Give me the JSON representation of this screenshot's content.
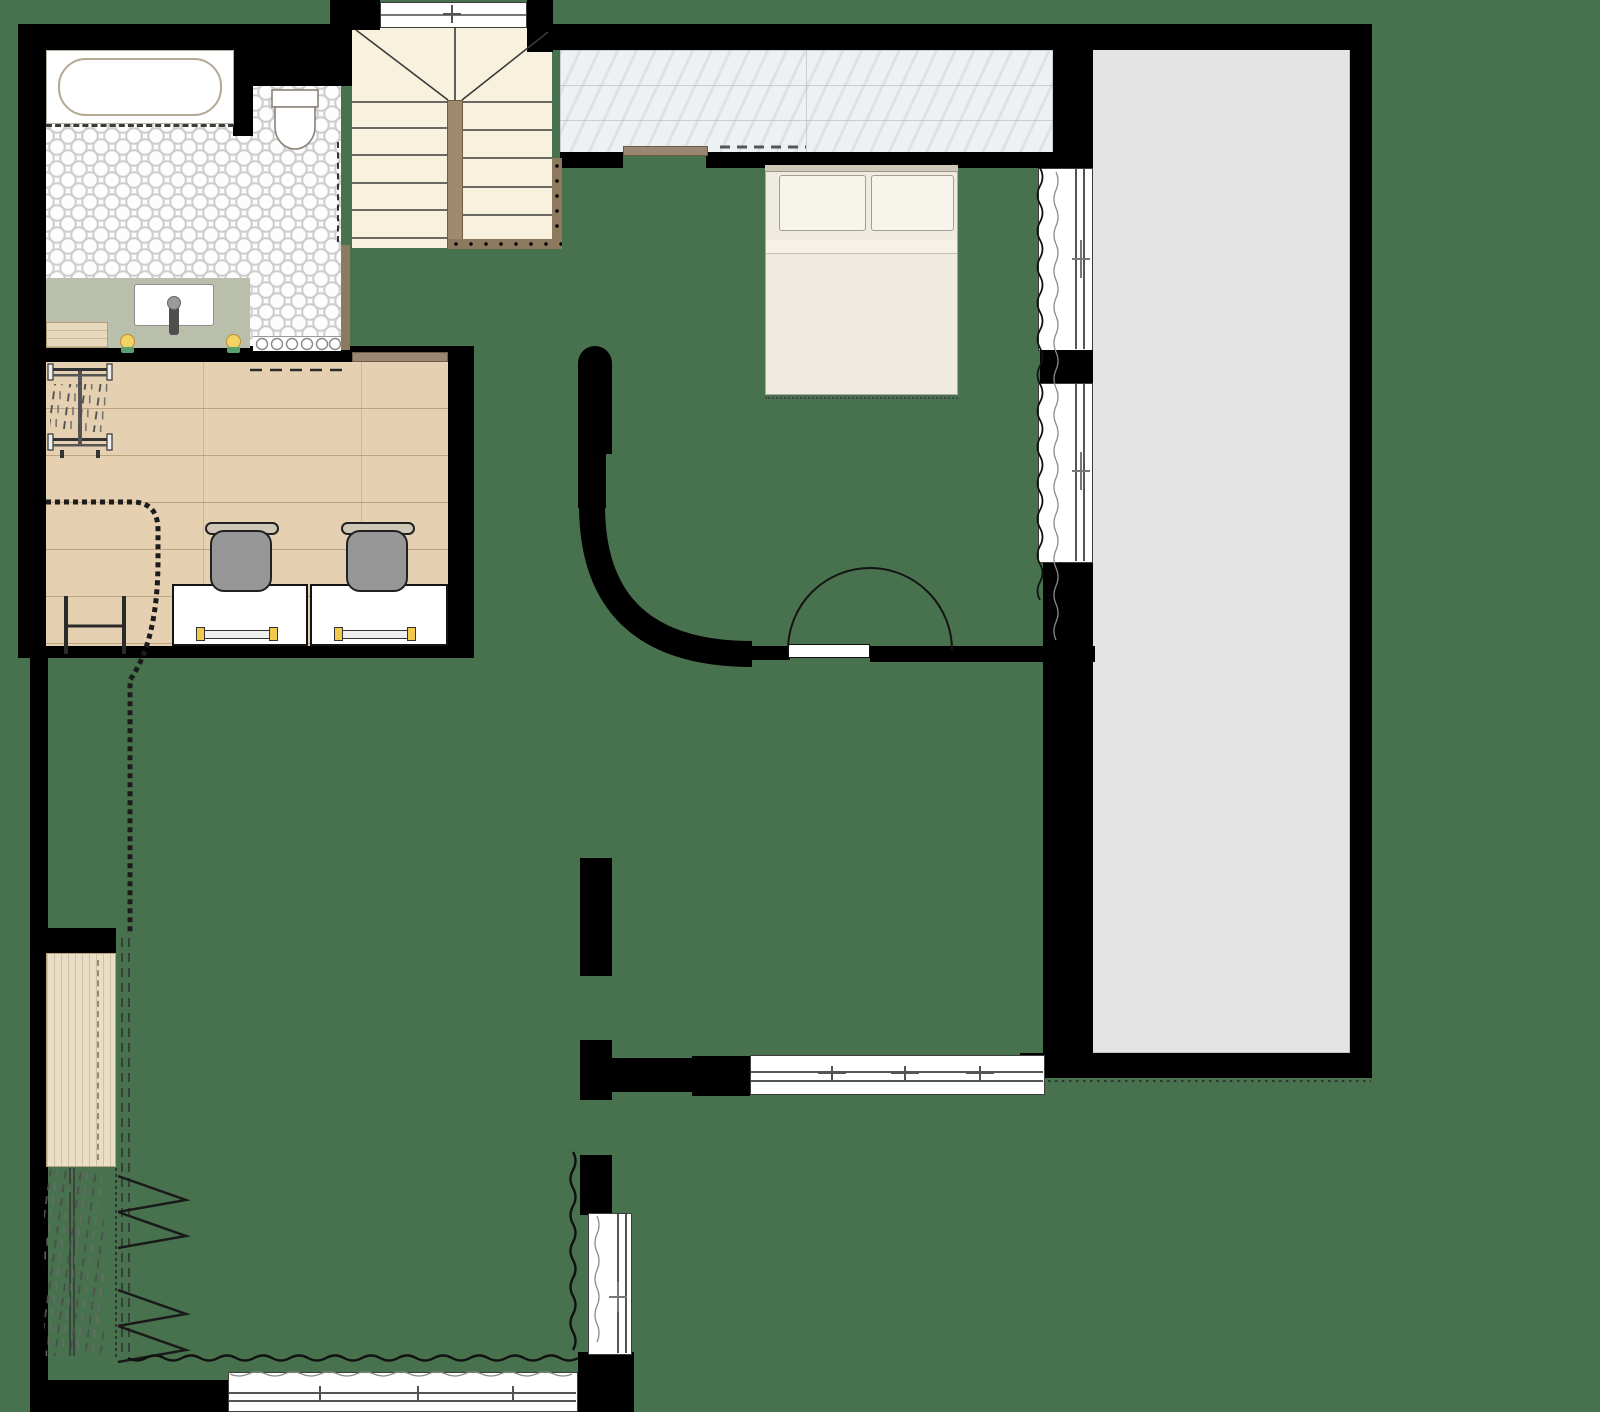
{
  "title": "apartment-upper-floor-plan",
  "colors": {
    "bg": "#48724e",
    "wall": "#000000",
    "stair": "#f8f1dd",
    "stairwood": "#a08a6e",
    "rail": "#8d7a5e",
    "marble": "#eef1f2",
    "terrace": "#e4e4e4",
    "vanity": "#b9bfaa",
    "wood": "#e5d1b1",
    "panelwood": "#e9dec6",
    "linen": "#f0ebe0",
    "pillow": "#f7f4ec",
    "shelf": "#9b8671",
    "chair": "#979797",
    "lamp": "#f2c94c",
    "candle": "#f2d465",
    "candlebase": "#58a070",
    "win": "#ffffff"
  },
  "legend": {
    "rooms": [
      "bathroom",
      "staircase",
      "wardrobe-corridor",
      "bedroom",
      "terrace-void",
      "office",
      "hallway",
      "dressing-room"
    ],
    "fixtures": [
      "bathtub",
      "toilet",
      "vanity-sink",
      "faucet",
      "candles",
      "bottle-shelf",
      "double-bed",
      "pillows",
      "closet-rod",
      "closet-shelf",
      "desks",
      "desk-lamps",
      "office-chairs",
      "garment-rack",
      "bench",
      "chain-divider",
      "clothes-rail",
      "hangers",
      "curtains",
      "sliding-windows",
      "stair-railing"
    ]
  }
}
